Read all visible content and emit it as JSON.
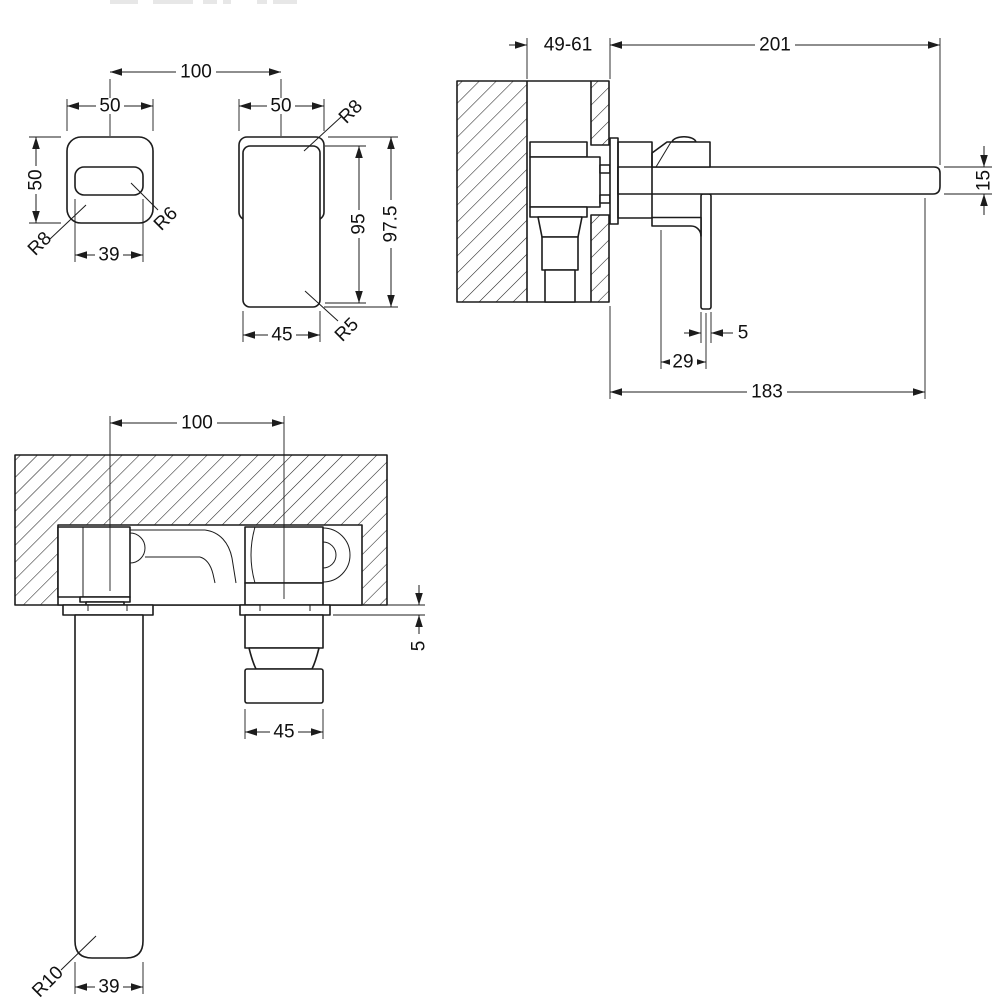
{
  "drawing": {
    "kind": "wall-mounted basin mixer tap installation drawing",
    "colors": {
      "ink": "#1c1c1c",
      "paper": "#ffffff"
    },
    "views": {
      "spout_front": {
        "dims": {
          "center_distance": "100",
          "plate_width": "50",
          "plate_height": "50",
          "outlet_width": "39",
          "plate_corner_radius": "R8",
          "outlet_corner_radius": "R6"
        }
      },
      "handle_front": {
        "dims": {
          "plate_width": "50",
          "body_height": "95",
          "total_height": "97.5",
          "body_width": "45",
          "top_corner_radius": "R8",
          "bottom_corner_radius": "R5"
        }
      },
      "side_section": {
        "dims": {
          "wall_depth_range": "49-61",
          "spout_reach": "201",
          "spout_thickness": "15",
          "lever_thickness": "5",
          "lever_offset": "29",
          "outlet_projection": "183"
        }
      },
      "front_section": {
        "dims": {
          "center_distance": "100",
          "plate_thickness": "5",
          "handle_width": "45",
          "spout_width": "39",
          "spout_end_radius": "R10"
        }
      }
    }
  }
}
